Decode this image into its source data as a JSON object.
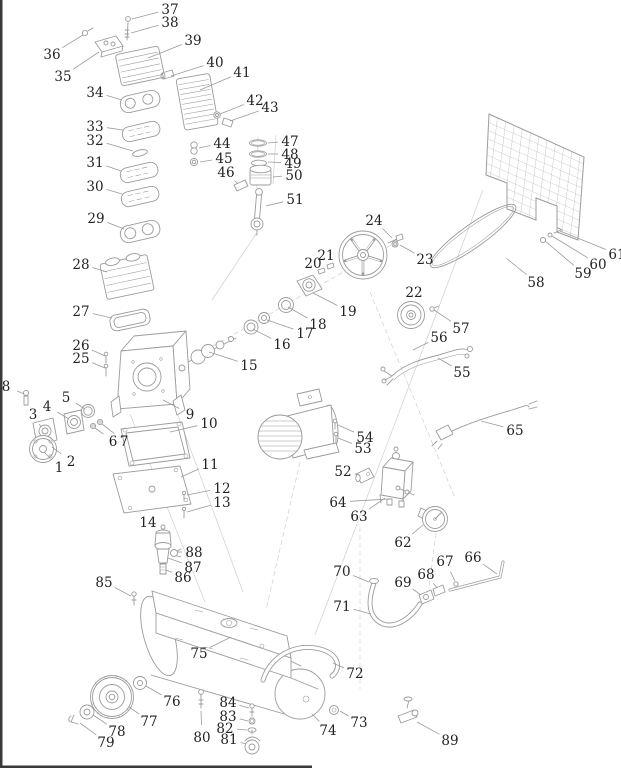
{
  "diagram": {
    "background": "#ffffff",
    "line_color": "#9b9b9b",
    "construction_color": "#cfcfcf",
    "label_color": "#232323",
    "edge_bar_color": "#3a3a3a",
    "label_font_size": 13.5,
    "part_count": 89
  },
  "parts": [
    {
      "num": "1",
      "lx": 59,
      "ly": 467,
      "tx": 44,
      "ty": 452
    },
    {
      "num": "2",
      "lx": 71,
      "ly": 461,
      "tx": 52,
      "ty": 447
    },
    {
      "num": "3",
      "lx": 33,
      "ly": 414,
      "tx": 41,
      "ty": 427
    },
    {
      "num": "4",
      "lx": 47,
      "ly": 406,
      "tx": 69,
      "ty": 419
    },
    {
      "num": "5",
      "lx": 66,
      "ly": 397,
      "tx": 85,
      "ty": 409
    },
    {
      "num": "6",
      "lx": 113,
      "ly": 441,
      "tx": 95,
      "ty": 428
    },
    {
      "num": "7",
      "lx": 124,
      "ly": 441,
      "tx": 102,
      "ty": 424
    },
    {
      "num": "8",
      "lx": 6,
      "ly": 386,
      "tx": 24,
      "ty": 394
    },
    {
      "num": "9",
      "lx": 190,
      "ly": 414,
      "tx": 163,
      "ty": 400
    },
    {
      "num": "10",
      "lx": 209,
      "ly": 423,
      "tx": 170,
      "ty": 432
    },
    {
      "num": "11",
      "lx": 210,
      "ly": 464,
      "tx": 181,
      "ty": 477
    },
    {
      "num": "12",
      "lx": 222,
      "ly": 488,
      "tx": 187,
      "ty": 495
    },
    {
      "num": "13",
      "lx": 222,
      "ly": 502,
      "tx": 187,
      "ty": 512
    },
    {
      "num": "14",
      "lx": 148,
      "ly": 522,
      "tx": 158,
      "ty": 530
    },
    {
      "num": "15",
      "lx": 249,
      "ly": 365,
      "tx": 209,
      "ty": 352
    },
    {
      "num": "16",
      "lx": 282,
      "ly": 344,
      "tx": 253,
      "ty": 329
    },
    {
      "num": "17",
      "lx": 305,
      "ly": 333,
      "tx": 267,
      "ty": 320
    },
    {
      "num": "18",
      "lx": 318,
      "ly": 324,
      "tx": 288,
      "ty": 307
    },
    {
      "num": "19",
      "lx": 348,
      "ly": 311,
      "tx": 313,
      "ty": 293
    },
    {
      "num": "20",
      "lx": 313,
      "ly": 263,
      "tx": 319,
      "ty": 270
    },
    {
      "num": "21",
      "lx": 326,
      "ly": 255,
      "tx": 329,
      "ty": 265
    },
    {
      "num": "22",
      "lx": 414,
      "ly": 292,
      "tx": 412,
      "ty": 304
    },
    {
      "num": "23",
      "lx": 425,
      "ly": 259,
      "tx": 400,
      "ty": 245
    },
    {
      "num": "24",
      "lx": 374,
      "ly": 220,
      "tx": 392,
      "ty": 238
    },
    {
      "num": "25",
      "lx": 81,
      "ly": 358,
      "tx": 105,
      "ty": 368
    },
    {
      "num": "26",
      "lx": 81,
      "ly": 345,
      "tx": 105,
      "ty": 356
    },
    {
      "num": "27",
      "lx": 81,
      "ly": 311,
      "tx": 112,
      "ty": 318
    },
    {
      "num": "28",
      "lx": 81,
      "ly": 264,
      "tx": 107,
      "ty": 272
    },
    {
      "num": "29",
      "lx": 96,
      "ly": 218,
      "tx": 124,
      "ty": 229
    },
    {
      "num": "30",
      "lx": 95,
      "ly": 186,
      "tx": 122,
      "ty": 194
    },
    {
      "num": "31",
      "lx": 95,
      "ly": 162,
      "tx": 121,
      "ty": 171
    },
    {
      "num": "32",
      "lx": 95,
      "ly": 140,
      "tx": 133,
      "ty": 151
    },
    {
      "num": "33",
      "lx": 95,
      "ly": 126,
      "tx": 123,
      "ty": 130
    },
    {
      "num": "34",
      "lx": 95,
      "ly": 92,
      "tx": 122,
      "ty": 100
    },
    {
      "num": "35",
      "lx": 63,
      "ly": 76,
      "tx": 99,
      "ty": 52
    },
    {
      "num": "36",
      "lx": 52,
      "ly": 54,
      "tx": 83,
      "ty": 35
    },
    {
      "num": "37",
      "lx": 170,
      "ly": 9,
      "tx": 132,
      "ty": 19
    },
    {
      "num": "38",
      "lx": 170,
      "ly": 22,
      "tx": 131,
      "ty": 33
    },
    {
      "num": "39",
      "lx": 193,
      "ly": 40,
      "tx": 148,
      "ty": 58
    },
    {
      "num": "40",
      "lx": 215,
      "ly": 62,
      "tx": 171,
      "ty": 76
    },
    {
      "num": "41",
      "lx": 242,
      "ly": 72,
      "tx": 200,
      "ty": 90
    },
    {
      "num": "42",
      "lx": 255,
      "ly": 100,
      "tx": 220,
      "ty": 114
    },
    {
      "num": "43",
      "lx": 270,
      "ly": 107,
      "tx": 230,
      "ty": 121
    },
    {
      "num": "44",
      "lx": 222,
      "ly": 143,
      "tx": 199,
      "ty": 148
    },
    {
      "num": "45",
      "lx": 224,
      "ly": 158,
      "tx": 200,
      "ty": 162
    },
    {
      "num": "46",
      "lx": 226,
      "ly": 172,
      "tx": 238,
      "ty": 184
    },
    {
      "num": "47",
      "lx": 290,
      "ly": 141,
      "tx": 268,
      "ty": 143
    },
    {
      "num": "48",
      "lx": 290,
      "ly": 154,
      "tx": 268,
      "ty": 154
    },
    {
      "num": "49",
      "lx": 293,
      "ly": 163,
      "tx": 268,
      "ty": 162
    },
    {
      "num": "50",
      "lx": 294,
      "ly": 175,
      "tx": 273,
      "ty": 177
    },
    {
      "num": "51",
      "lx": 295,
      "ly": 199,
      "tx": 266,
      "ty": 206
    },
    {
      "num": "52",
      "lx": 343,
      "ly": 471,
      "tx": 359,
      "ty": 475
    },
    {
      "num": "53",
      "lx": 363,
      "ly": 448,
      "tx": 338,
      "ty": 438
    },
    {
      "num": "54",
      "lx": 365,
      "ly": 437,
      "tx": 338,
      "ty": 425
    },
    {
      "num": "55",
      "lx": 462,
      "ly": 372,
      "tx": 438,
      "ty": 358
    },
    {
      "num": "56",
      "lx": 439,
      "ly": 337,
      "tx": 413,
      "ty": 350
    },
    {
      "num": "57",
      "lx": 461,
      "ly": 328,
      "tx": 434,
      "ty": 310
    },
    {
      "num": "58",
      "lx": 536,
      "ly": 282,
      "tx": 506,
      "ty": 258
    },
    {
      "num": "59",
      "lx": 583,
      "ly": 273,
      "tx": 545,
      "ty": 241
    },
    {
      "num": "60",
      "lx": 598,
      "ly": 264,
      "tx": 552,
      "ty": 236
    },
    {
      "num": "61",
      "lx": 617,
      "ly": 254,
      "tx": 560,
      "ty": 231
    },
    {
      "num": "62",
      "lx": 403,
      "ly": 542,
      "tx": 423,
      "ty": 525
    },
    {
      "num": "63",
      "lx": 359,
      "ly": 516,
      "tx": 385,
      "ty": 498
    },
    {
      "num": "64",
      "lx": 338,
      "ly": 502,
      "tx": 389,
      "ty": 499
    },
    {
      "num": "65",
      "lx": 515,
      "ly": 430,
      "tx": 481,
      "ty": 421
    },
    {
      "num": "66",
      "lx": 473,
      "ly": 557,
      "tx": 497,
      "ty": 574
    },
    {
      "num": "67",
      "lx": 445,
      "ly": 561,
      "tx": 455,
      "ty": 581
    },
    {
      "num": "68",
      "lx": 426,
      "ly": 574,
      "tx": 437,
      "ty": 588
    },
    {
      "num": "69",
      "lx": 403,
      "ly": 582,
      "tx": 421,
      "ty": 595
    },
    {
      "num": "70",
      "lx": 342,
      "ly": 571,
      "tx": 369,
      "ty": 582
    },
    {
      "num": "71",
      "lx": 342,
      "ly": 606,
      "tx": 371,
      "ty": 614
    },
    {
      "num": "72",
      "lx": 355,
      "ly": 673,
      "tx": 333,
      "ty": 663
    },
    {
      "num": "73",
      "lx": 359,
      "ly": 722,
      "tx": 340,
      "ty": 711
    },
    {
      "num": "74",
      "lx": 328,
      "ly": 730,
      "tx": 312,
      "ty": 714
    },
    {
      "num": "75",
      "lx": 199,
      "ly": 653,
      "tx": 231,
      "ty": 637
    },
    {
      "num": "76",
      "lx": 172,
      "ly": 701,
      "tx": 146,
      "ty": 686
    },
    {
      "num": "77",
      "lx": 149,
      "ly": 721,
      "tx": 129,
      "ty": 707
    },
    {
      "num": "78",
      "lx": 117,
      "ly": 731,
      "tx": 93,
      "ty": 715
    },
    {
      "num": "79",
      "lx": 106,
      "ly": 742,
      "tx": 80,
      "ty": 723
    },
    {
      "num": "80",
      "lx": 202,
      "ly": 737,
      "tx": 201,
      "ty": 711
    },
    {
      "num": "81",
      "lx": 229,
      "ly": 739,
      "tx": 246,
      "ty": 744
    },
    {
      "num": "82",
      "lx": 225,
      "ly": 728,
      "tx": 247,
      "ty": 730
    },
    {
      "num": "83",
      "lx": 228,
      "ly": 716,
      "tx": 248,
      "ty": 721
    },
    {
      "num": "84",
      "lx": 228,
      "ly": 702,
      "tx": 249,
      "ty": 708
    },
    {
      "num": "85",
      "lx": 104,
      "ly": 582,
      "tx": 131,
      "ty": 596
    },
    {
      "num": "86",
      "lx": 183,
      "ly": 577,
      "tx": 166,
      "ty": 570
    },
    {
      "num": "87",
      "lx": 193,
      "ly": 567,
      "tx": 168,
      "ty": 558
    },
    {
      "num": "88",
      "lx": 194,
      "ly": 552,
      "tx": 177,
      "ty": 552
    },
    {
      "num": "89",
      "lx": 450,
      "ly": 740,
      "tx": 417,
      "ty": 722
    }
  ]
}
